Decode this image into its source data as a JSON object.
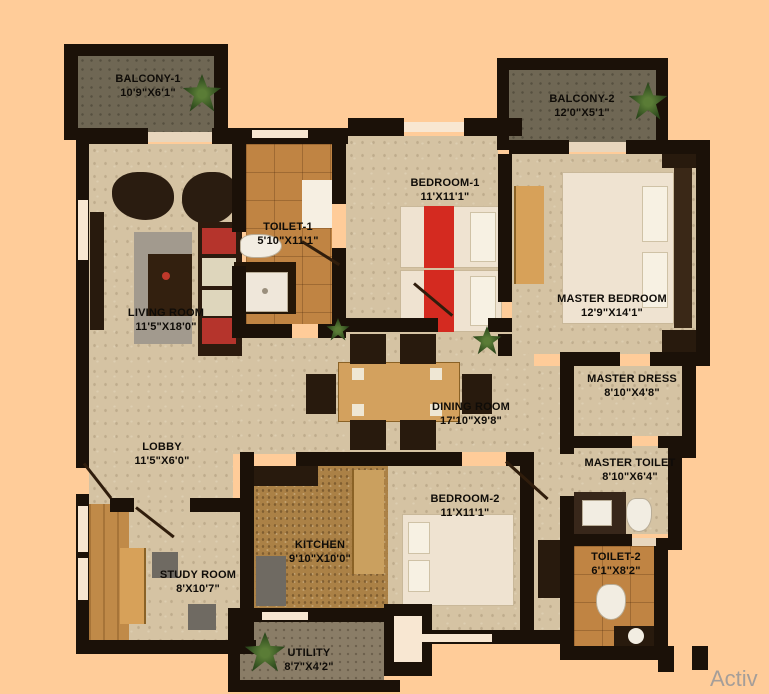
{
  "plan": {
    "type": "apartment-floor-plan",
    "watermark_partial": "Activ"
  },
  "palette": {
    "background": "#ffcc99",
    "wall": "#1b1108",
    "floor_stone": "#d5c3a3",
    "floor_tile": "#c08443",
    "accent_red": "#cc3026",
    "bed_cream": "#efe3d1",
    "wood": "#d7a159",
    "plant_green": "#2e4a1d"
  },
  "rooms": {
    "balcony1": {
      "name": "BALCONY-1",
      "dims": "10'9\"X6'1\""
    },
    "balcony2": {
      "name": "BALCONY-2",
      "dims": "12'0\"X5'1\""
    },
    "toilet1": {
      "name": "TOILET-1",
      "dims": "5'10\"X11'1\""
    },
    "bedroom1": {
      "name": "BEDROOM-1",
      "dims": "11'X11'1\""
    },
    "master_bedroom": {
      "name": "MASTER BEDROOM",
      "dims": "12'9\"X14'1\""
    },
    "living_room": {
      "name": "LIVING ROOM",
      "dims": "11'5\"X18'0\""
    },
    "master_dress": {
      "name": "MASTER DRESS",
      "dims": "8'10\"X4'8\""
    },
    "dining_room": {
      "name": "DINING ROOM",
      "dims": "17'10\"X9'8\""
    },
    "lobby": {
      "name": "LOBBY",
      "dims": "11'5\"X6'0\""
    },
    "master_toilet": {
      "name": "MASTER TOILET",
      "dims": "8'10\"X6'4\""
    },
    "bedroom2": {
      "name": "BEDROOM-2",
      "dims": "11'X11'1\""
    },
    "study_room": {
      "name": "STUDY ROOM",
      "dims": "8'X10'7\""
    },
    "kitchen": {
      "name": "KITCHEN",
      "dims": "9'10\"X10'0\""
    },
    "toilet2": {
      "name": "TOILET-2",
      "dims": "6'1\"X8'2\""
    },
    "utility": {
      "name": "UTILITY",
      "dims": "8'7\"X4'2\""
    }
  }
}
